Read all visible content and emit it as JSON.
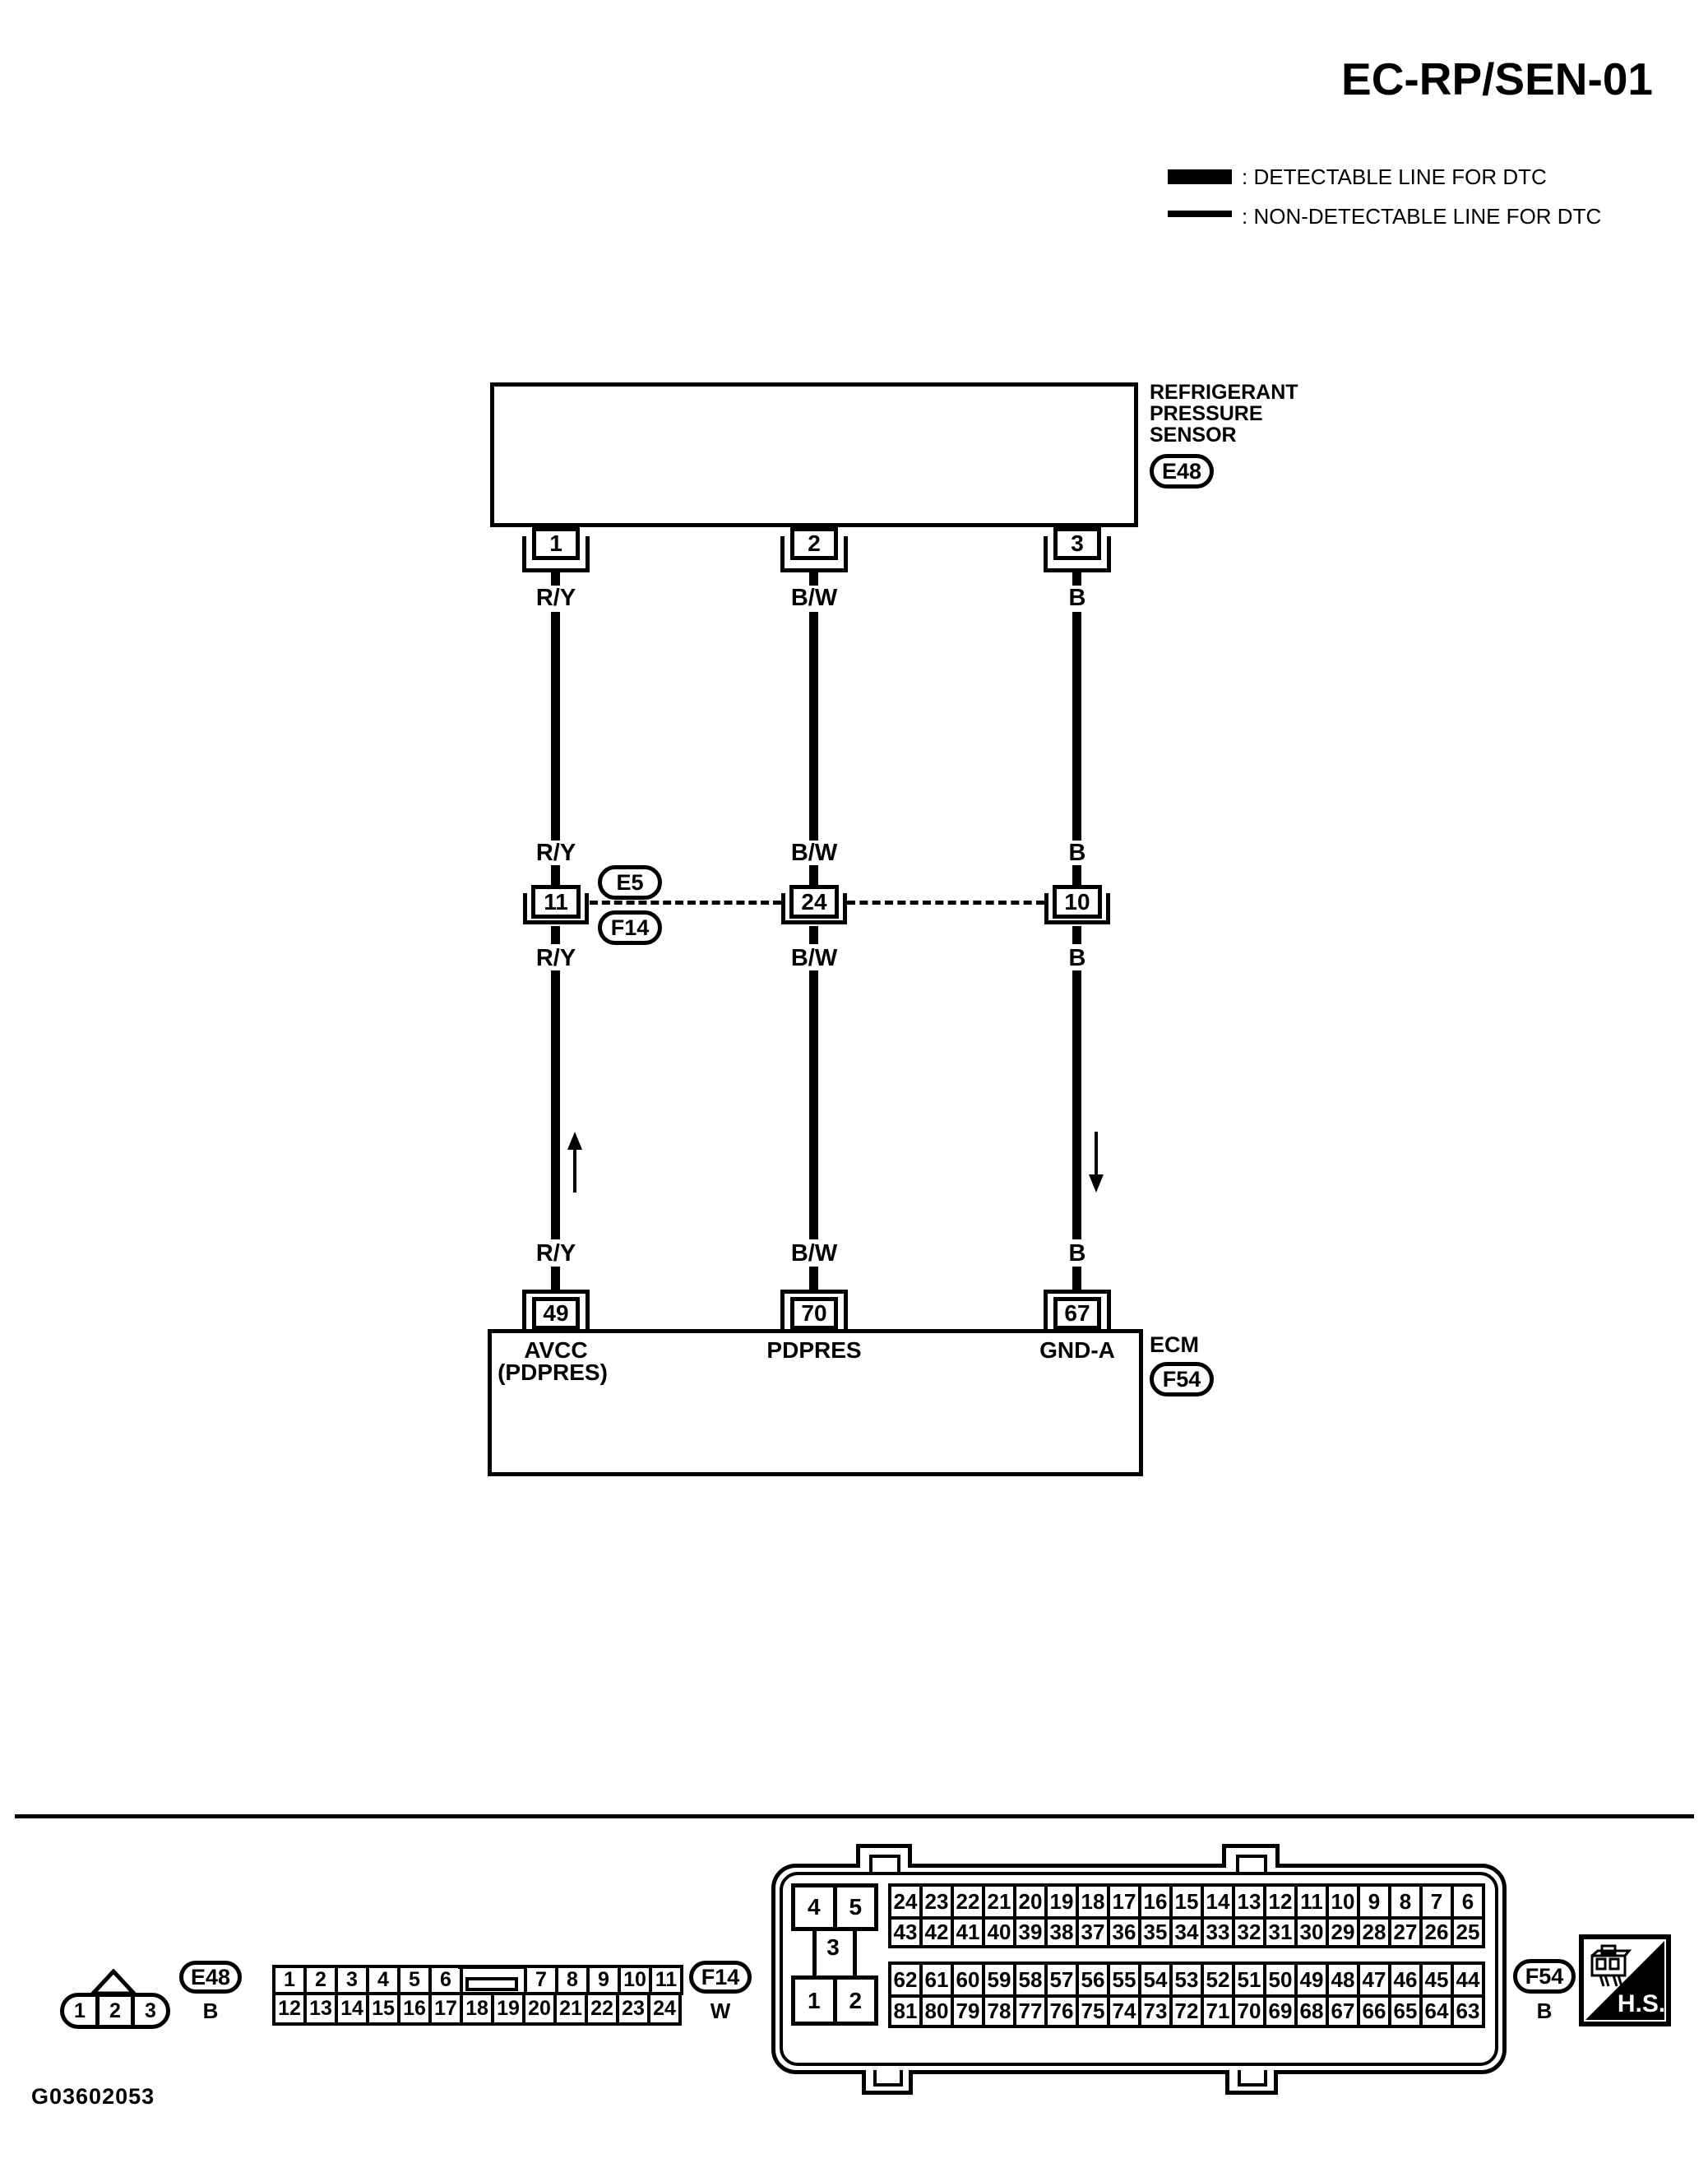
{
  "colors": {
    "ink": "#000000",
    "paper": "#ffffff"
  },
  "title": "EC-RP/SEN-01",
  "legend": {
    "detectable_label": ": DETECTABLE LINE FOR DTC",
    "non_detectable_label": ": NON-DETECTABLE LINE FOR DTC"
  },
  "sensor": {
    "name_lines": [
      "REFRIGERANT",
      "PRESSURE",
      "SENSOR"
    ],
    "connector_id": "E48"
  },
  "columns": [
    {
      "wire_color": "R/Y",
      "sensor_pin": "1",
      "mid_pin": "11",
      "ecm_pin": "49",
      "ecm_signal": "AVCC",
      "ecm_signal_sub": "(PDPRES)",
      "arrow": "up"
    },
    {
      "wire_color": "B/W",
      "sensor_pin": "2",
      "mid_pin": "24",
      "ecm_pin": "70",
      "ecm_signal": "PDPRES",
      "ecm_signal_sub": "",
      "arrow": "none"
    },
    {
      "wire_color": "B",
      "sensor_pin": "3",
      "mid_pin": "10",
      "ecm_pin": "67",
      "ecm_signal": "GND-A",
      "ecm_signal_sub": "",
      "arrow": "down"
    }
  ],
  "inline_connectors": {
    "above": "E5",
    "below": "F14"
  },
  "ecm": {
    "name": "ECM",
    "connector_id": "F54"
  },
  "bottom": {
    "e48_connector": {
      "id": "E48",
      "wire_color": "B",
      "pins": [
        "1",
        "2",
        "3"
      ]
    },
    "f14_connector": {
      "id": "F14",
      "wire_color": "W",
      "row1_left": [
        "1",
        "2",
        "3",
        "4",
        "5",
        "6"
      ],
      "row1_right": [
        "7",
        "8",
        "9",
        "10",
        "11"
      ],
      "row2": [
        "12",
        "13",
        "14",
        "15",
        "16",
        "17",
        "18",
        "19",
        "20",
        "21",
        "22",
        "23",
        "24"
      ]
    },
    "f54_connector": {
      "id": "F54",
      "wire_color": "B",
      "left_top": [
        "4",
        "5"
      ],
      "left_mid": "3",
      "left_bottom": [
        "1",
        "2"
      ],
      "row1": [
        "24",
        "23",
        "22",
        "21",
        "20",
        "19",
        "18",
        "17",
        "16",
        "15",
        "14",
        "13",
        "12",
        "11",
        "10",
        "9",
        "8",
        "7",
        "6"
      ],
      "row2": [
        "43",
        "42",
        "41",
        "40",
        "39",
        "38",
        "37",
        "36",
        "35",
        "34",
        "33",
        "32",
        "31",
        "30",
        "29",
        "28",
        "27",
        "26",
        "25"
      ],
      "row3": [
        "62",
        "61",
        "60",
        "59",
        "58",
        "57",
        "56",
        "55",
        "54",
        "53",
        "52",
        "51",
        "50",
        "49",
        "48",
        "47",
        "46",
        "45",
        "44"
      ],
      "row4": [
        "81",
        "80",
        "79",
        "78",
        "77",
        "76",
        "75",
        "74",
        "73",
        "72",
        "71",
        "70",
        "69",
        "68",
        "67",
        "66",
        "65",
        "64",
        "63"
      ]
    },
    "hs_mark": "H.S."
  },
  "footer": {
    "figure_code": "G03602053"
  }
}
